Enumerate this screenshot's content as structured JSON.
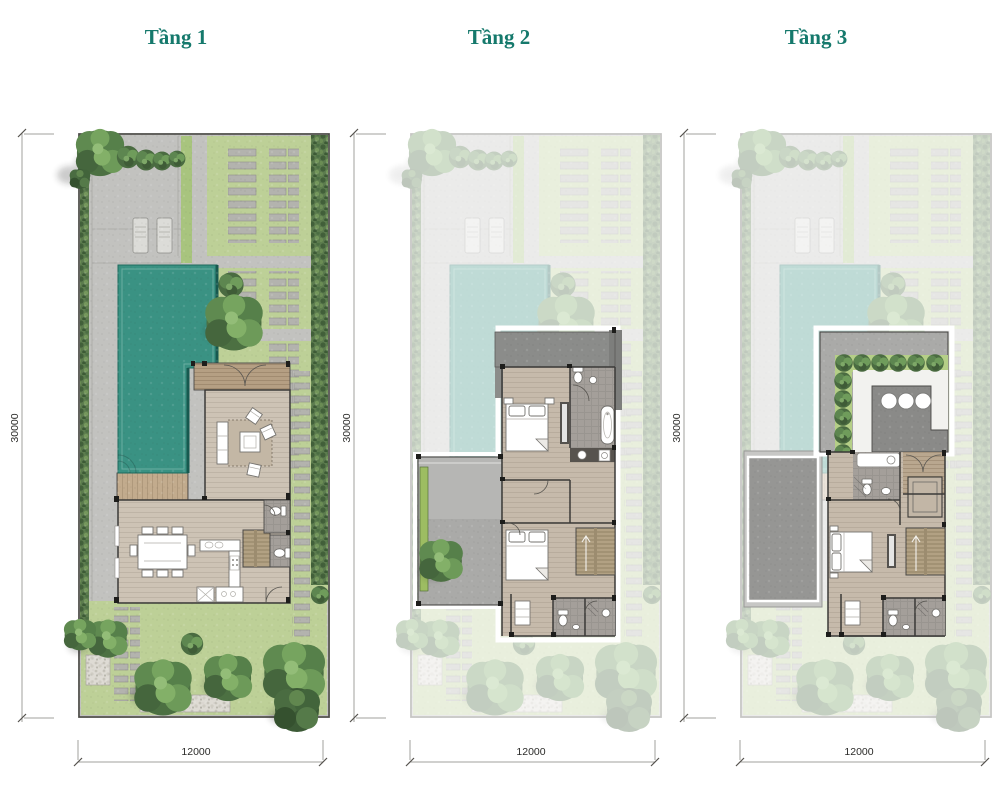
{
  "panels": [
    {
      "title": "Tầng 1",
      "height_label": "30000",
      "width_label": "12000"
    },
    {
      "title": "Tầng 2",
      "height_label": "30000",
      "width_label": "12000"
    },
    {
      "title": "Tầng 3",
      "height_label": "30000",
      "width_label": "12000"
    }
  ],
  "colors": {
    "title_accent": "#15796c",
    "pool_water": "#3a9283",
    "lawn": "#bdd097",
    "paving": "#c2c2bf",
    "wood_floor": "#cdc3b5",
    "terrace_deck": "#b59f83",
    "hedge": "#5c7c4e",
    "planter": "#9dbd62",
    "roof_gray": "#969694",
    "dimension_text": "#2b2b29"
  }
}
